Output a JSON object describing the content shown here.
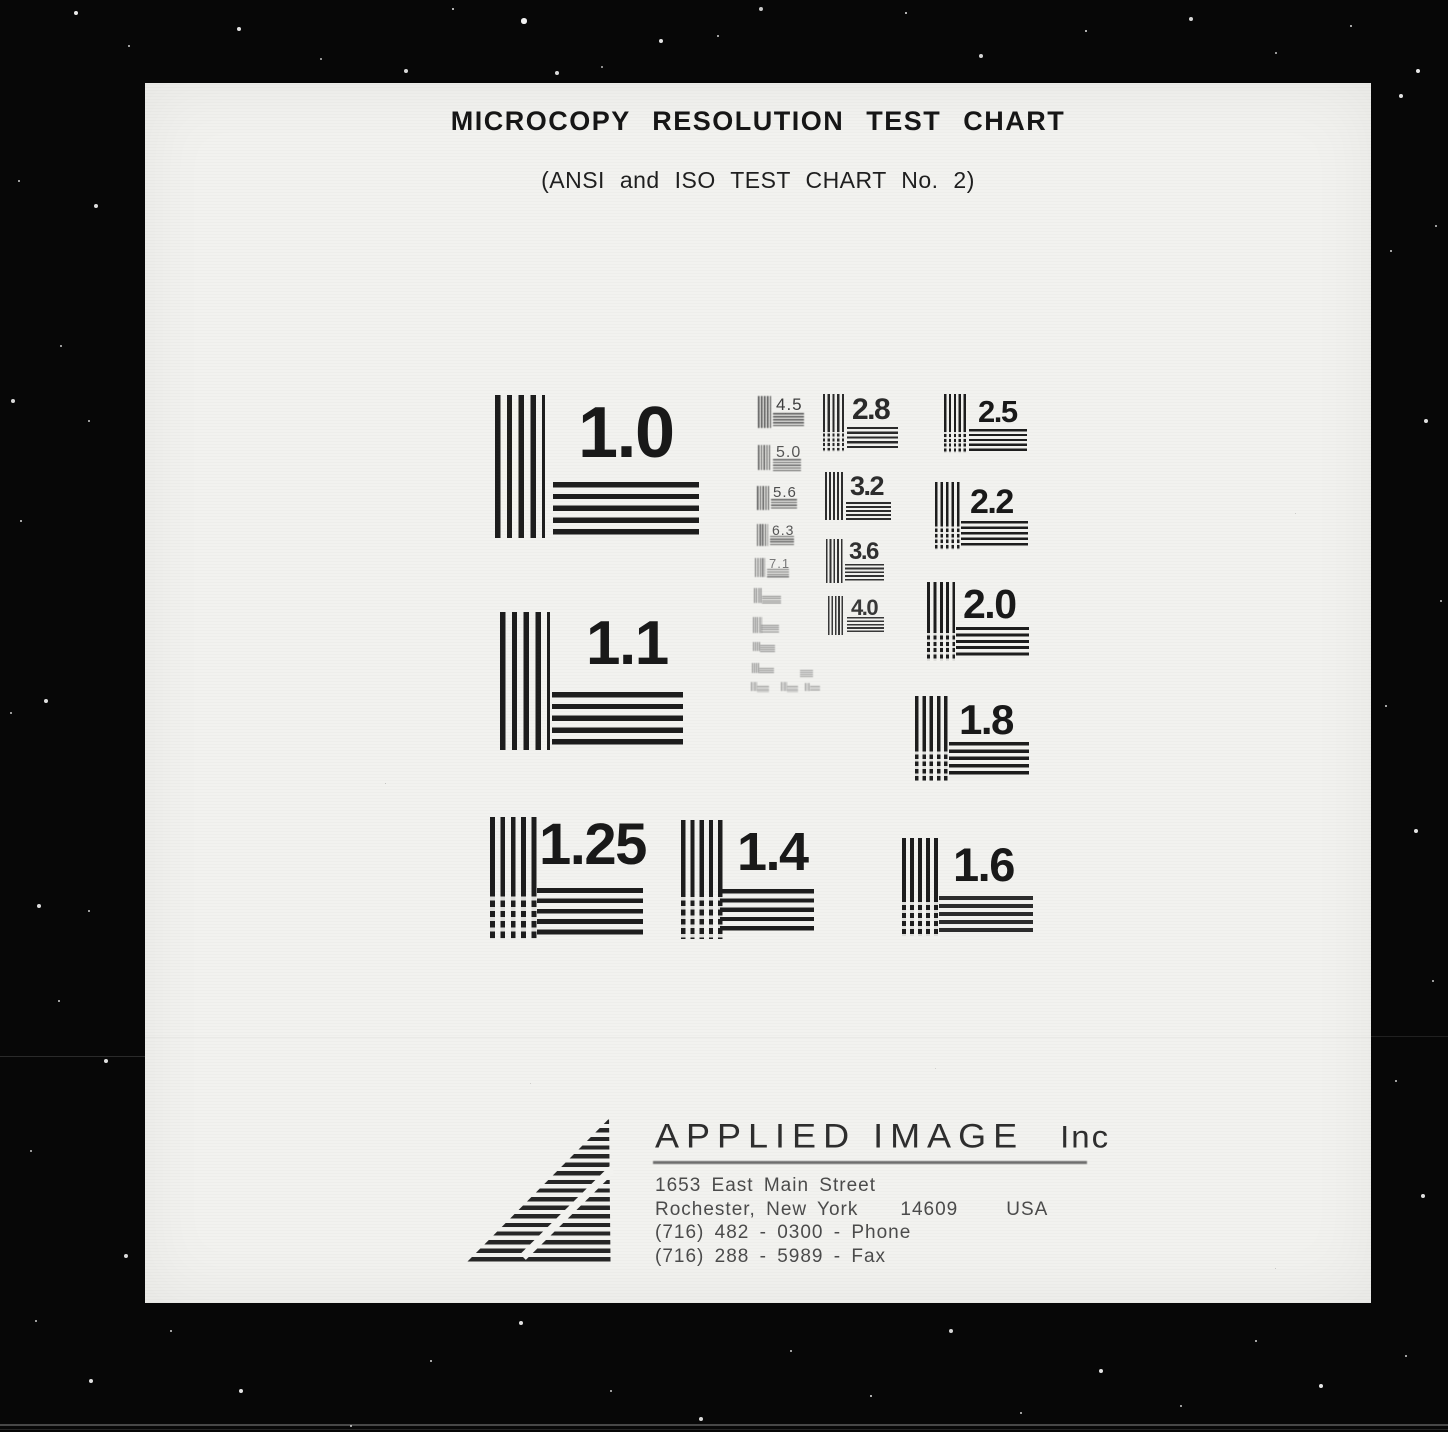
{
  "document": {
    "title": "MICROCOPY RESOLUTION TEST CHART",
    "subtitle": "(ANSI and ISO TEST CHART No. 2)"
  },
  "patterns": [
    {
      "label": "1.0"
    },
    {
      "label": "1.1"
    },
    {
      "label": "1.25"
    },
    {
      "label": "1.4"
    },
    {
      "label": "1.6"
    },
    {
      "label": "1.8"
    },
    {
      "label": "2.0"
    },
    {
      "label": "2.2"
    },
    {
      "label": "2.5"
    },
    {
      "label": "2.8"
    },
    {
      "label": "3.2"
    },
    {
      "label": "3.6"
    },
    {
      "label": "4.0"
    },
    {
      "label": "4.5"
    },
    {
      "label": "5.0"
    },
    {
      "label": "5.6"
    },
    {
      "label": "6.3"
    },
    {
      "label": "7.1"
    }
  ],
  "company": {
    "name": "APPLIED IMAGE",
    "suffix": "Inc",
    "address_line1": "1653 East Main Street",
    "city": "Rochester, New York",
    "zip": "14609",
    "country": "USA",
    "phone": "(716) 482 - 0300 - Phone",
    "fax": "(716) 288 - 5989 - Fax"
  },
  "colors": {
    "film_black": "#070707",
    "page_white": "#f2f2ef",
    "ink": "#1d1d1d"
  }
}
